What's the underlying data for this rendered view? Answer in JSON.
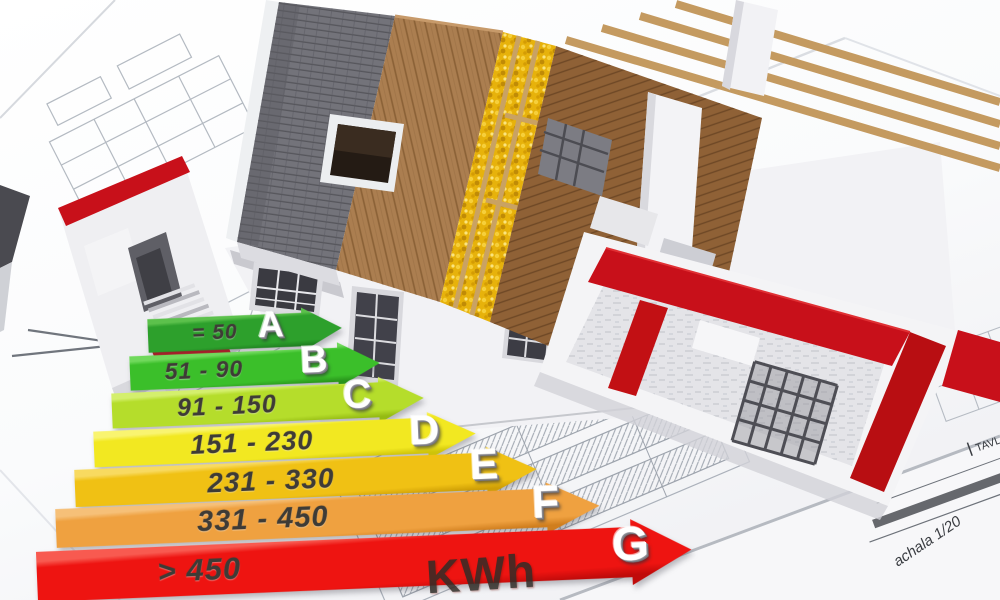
{
  "image": {
    "alt": "3D cutaway rendering of a house under construction standing on architectural blueprints, with a 3D energy efficiency rating arrow chart in the foreground"
  },
  "energy_chart": {
    "unit_label": "KWh",
    "rows": [
      {
        "grade": "A",
        "range": "= 50",
        "color": "#2da02c",
        "color_light": "#5cc14c",
        "color_dark": "#1e7d1f"
      },
      {
        "grade": "B",
        "range": "51 - 90",
        "color": "#3bbf2a",
        "color_light": "#70d95c",
        "color_dark": "#28941b"
      },
      {
        "grade": "C",
        "range": "91 - 150",
        "color": "#b5dd2b",
        "color_light": "#d4ef6d",
        "color_dark": "#95bb13"
      },
      {
        "grade": "D",
        "range": "151 - 230",
        "color": "#f2e821",
        "color_light": "#f9f470",
        "color_dark": "#cfc409"
      },
      {
        "grade": "E",
        "range": "231 - 330",
        "color": "#f0c114",
        "color_light": "#f8da60",
        "color_dark": "#cf9f06"
      },
      {
        "grade": "F",
        "range": "331 - 450",
        "color": "#efa140",
        "color_light": "#f6c078",
        "color_dark": "#d07e1e"
      },
      {
        "grade": "G",
        "range": "> 450",
        "color": "#ee1411",
        "color_light": "#f85a50",
        "color_dark": "#c00b0a"
      }
    ]
  },
  "chart_data": {
    "type": "bar",
    "title": "Energy efficiency classes",
    "categories": [
      "A",
      "B",
      "C",
      "D",
      "E",
      "F",
      "G"
    ],
    "labels": [
      "= 50",
      "51 - 90",
      "91 - 150",
      "151 - 230",
      "231 - 330",
      "331 - 450",
      "> 450"
    ],
    "range_min": [
      0,
      51,
      91,
      151,
      231,
      331,
      451
    ],
    "range_max": [
      50,
      90,
      150,
      230,
      330,
      450,
      null
    ],
    "unit": "KWh",
    "orientation": "horizontal-arrows",
    "legend_position": "none",
    "colors": [
      "#2da02c",
      "#3bbf2a",
      "#b5dd2b",
      "#f2e821",
      "#f0c114",
      "#efa140",
      "#ee1411"
    ]
  },
  "blueprint": {
    "annotations": {
      "scale_note": "achala 1/20",
      "sheet_note": "TAVL"
    }
  },
  "palette": {
    "red_walls": "#c8101a",
    "roof_tiles": "#73737a",
    "wood_sheathing": "#ab7e50",
    "insulation": "#e7b20b",
    "timber": "#c49a60",
    "blueprint_line": "#8d96a2"
  }
}
